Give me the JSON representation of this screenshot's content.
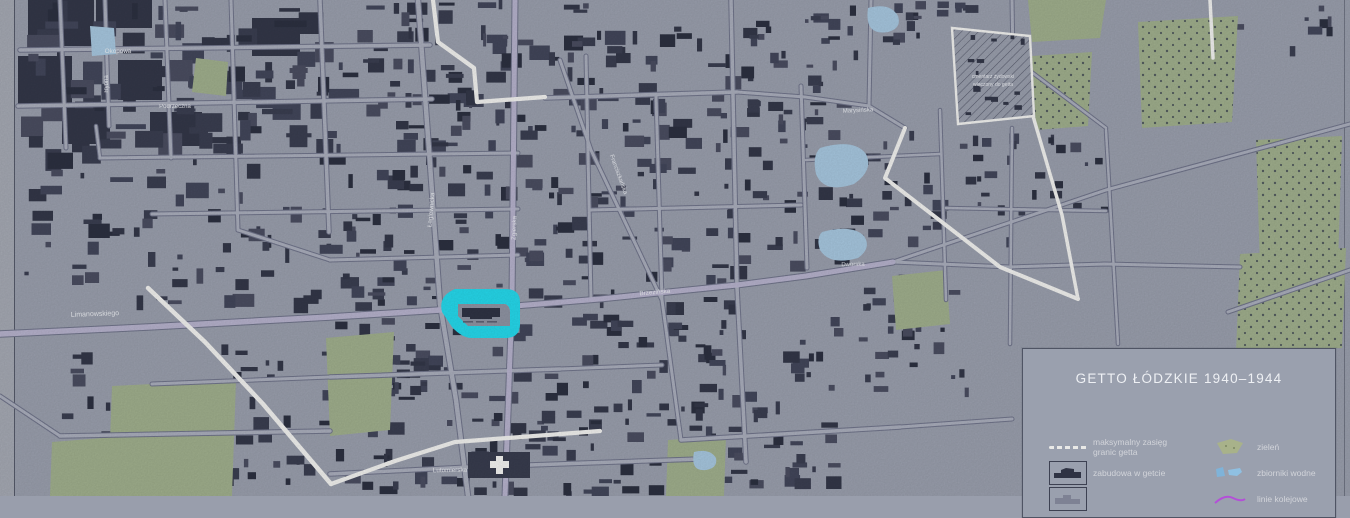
{
  "map_title": "GETTO ŁÓDZKIE 1940–1944",
  "legend": {
    "title": "GETTO ŁÓDZKIE 1940–1944",
    "left": [
      {
        "icon": "ghetto-extent-dashed-line",
        "label": "maksymalny zasięg granic getta"
      },
      {
        "icon": "building-in-ghetto",
        "label": "zabudowa w getcie"
      },
      {
        "icon": "building-outline",
        "label": ""
      }
    ],
    "right": [
      {
        "icon": "green-patch",
        "label": "zieleń"
      },
      {
        "icon": "water-patch",
        "label": "zbiorniki wodne"
      },
      {
        "icon": "railway-line",
        "label": "linie kolejowe"
      }
    ]
  },
  "annotations": {
    "cemetery_line1": "cmentarz żydowski",
    "cemetery_line2": "włączony do getta"
  },
  "street_labels": [
    "Okopowa",
    "Rybna",
    "Podrzeczna",
    "Limanowskiego",
    "Lutomierska",
    "Łagiewnicka",
    "Zgierska",
    "Brzezińska",
    "Dworska",
    "Marysińska",
    "Franciszkańska"
  ],
  "colors": {
    "background": "#999eac",
    "sheet_margin": "#a4a8b2",
    "building": "#383c4e",
    "road_fill": "#a9adbb",
    "road_casing": "#70748a",
    "main_road": "#b5b1cb",
    "boundary_white": "#f0f0ee",
    "green": "#9fae8c",
    "water": "#a6c6de",
    "highlight": "#25d7ea",
    "railway": "#b44fd8",
    "hatch": "#4a4e60",
    "label_text": "#eef0f4"
  }
}
